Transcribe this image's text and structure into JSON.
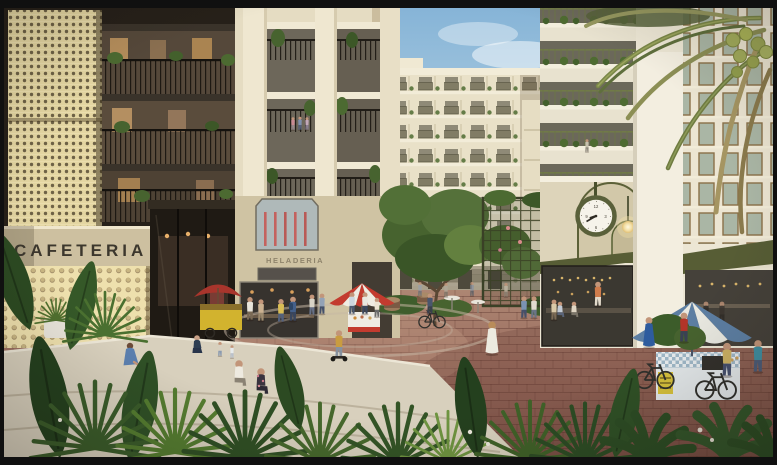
{
  "scene": {
    "type": "architectural-render",
    "description": "Sunlit courtyard plaza of a cream mid-rise residential complex with ground-floor cafes and shops, market carts, pedestrians, a wall clock, palm trees and tropical planting",
    "signs": {
      "cafeteria": "CAFETERIA",
      "heladeria": "HELADERIA"
    },
    "clock": {
      "time": "9:40"
    },
    "colors": {
      "frame": "#101010",
      "sky_top": "#86b4d7",
      "sky_bottom": "#e4eef2",
      "cream": "#ece4cc",
      "screen_gold": "#e4d6a2",
      "dark_structure": "#262019",
      "olive": "#575d35",
      "paving_red": "#9a6c5e",
      "concrete": "#d8d0bd",
      "foliage_dark": "#2c4a22",
      "foliage_mid": "#47632f",
      "umbrella_blue": "#5d7fa3",
      "umbrella_red": "#c33b2f",
      "cart_yellow": "#d2b32e"
    }
  }
}
